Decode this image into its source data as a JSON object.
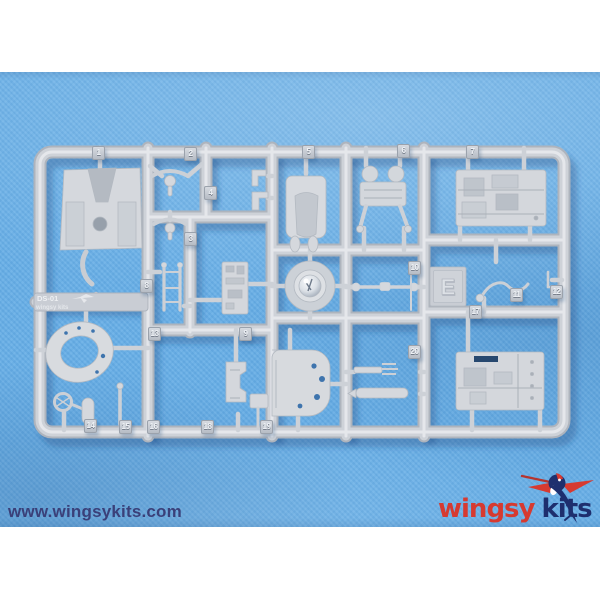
{
  "photo": {
    "fabric_color": "#66aee6",
    "plastic_color": "#d2d6db",
    "hole_color": "#3e74ad",
    "background_strip_color": "#ffffff"
  },
  "watermark": {
    "text": "www.wingsykits.com",
    "color": "#3a4079"
  },
  "logo": {
    "word1": "wingsy",
    "word2": "kits",
    "word1_color": "#d63a31",
    "word2_color": "#1e2f6e",
    "icon": "hummingbird-icon"
  },
  "sprue": {
    "code": "DS-01",
    "brand": "wingsy kits",
    "letter": "E",
    "part_tags": [
      {
        "n": "1",
        "x": 98,
        "y": 153
      },
      {
        "n": "2",
        "x": 190,
        "y": 154
      },
      {
        "n": "3",
        "x": 190,
        "y": 239
      },
      {
        "n": "4",
        "x": 210,
        "y": 193
      },
      {
        "n": "5",
        "x": 308,
        "y": 152
      },
      {
        "n": "6",
        "x": 403,
        "y": 151
      },
      {
        "n": "7",
        "x": 472,
        "y": 152
      },
      {
        "n": "8",
        "x": 146,
        "y": 286
      },
      {
        "n": "9",
        "x": 245,
        "y": 334
      },
      {
        "n": "10",
        "x": 414,
        "y": 268
      },
      {
        "n": "11",
        "x": 516,
        "y": 295
      },
      {
        "n": "12",
        "x": 556,
        "y": 292
      },
      {
        "n": "13",
        "x": 154,
        "y": 334
      },
      {
        "n": "14",
        "x": 90,
        "y": 426
      },
      {
        "n": "15",
        "x": 125,
        "y": 427
      },
      {
        "n": "16",
        "x": 153,
        "y": 427
      },
      {
        "n": "17",
        "x": 475,
        "y": 312
      },
      {
        "n": "18",
        "x": 207,
        "y": 427
      },
      {
        "n": "19",
        "x": 266,
        "y": 427
      },
      {
        "n": "20",
        "x": 414,
        "y": 352
      }
    ]
  }
}
